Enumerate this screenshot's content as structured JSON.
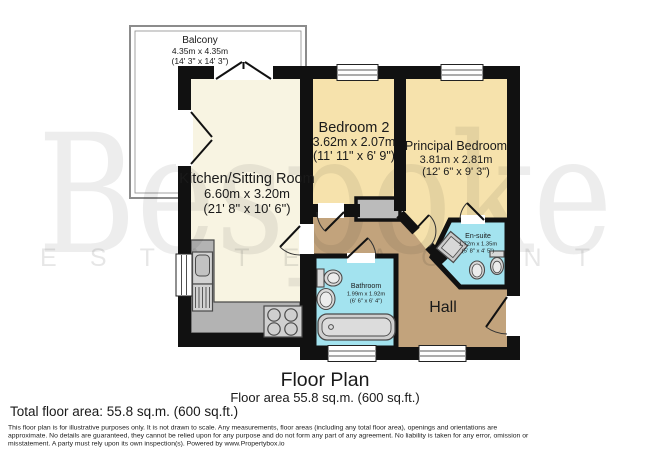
{
  "watermark": {
    "brand": "Bespoke",
    "tagline": "ESTATE AGENT"
  },
  "rooms": {
    "balcony": {
      "name": "Balcony",
      "metric": "4.35m x 4.35m",
      "imperial": "(14' 3\" x 14' 3\")"
    },
    "kitchen": {
      "name": "Kitchen/Sitting Room",
      "metric": "6.60m x 3.20m",
      "imperial": "(21' 8\" x 10' 6\")"
    },
    "bedroom2": {
      "name": "Bedroom 2",
      "metric": "3.62m x 2.07m",
      "imperial": "(11' 11\" x 6' 9\")"
    },
    "principal": {
      "name": "Principal Bedroom",
      "metric": "3.81m x 2.81m",
      "imperial": "(12' 6\" x 9' 3\")"
    },
    "ensuite": {
      "name": "En-suite",
      "metric": "1.72m x 1.35m",
      "imperial": "(5' 8\" x 4' 5\")"
    },
    "bathroom": {
      "name": "Bathroom",
      "metric": "1.99m x 1.92m",
      "imperial": "(6' 6\" x 6' 4\")"
    },
    "hall": {
      "name": "Hall"
    }
  },
  "footer": {
    "title": "Floor Plan",
    "area_line": "Floor area 55.8 sq.m. (600 sq.ft.)",
    "total_area": "Total floor area: 55.8 sq.m. (600 sq.ft.)",
    "disclaimer": [
      "This floor plan is for illustrative purposes only. It is not drawn to scale. Any measurements, floor areas (including any total floor area), openings and orientations are",
      "approximate. No details are guaranteed, they cannot be relied upon for any purpose and do not form any part of any agreement. No liability is taken for any error, omission or",
      "misstatement. A party must rely upon its own inspection(s). Powered by www.Propertybox.io"
    ]
  },
  "colors": {
    "wall": "#111111",
    "kitchen_floor": "#F8F4E2",
    "bedroom_floor": "#F6E2AC",
    "wet_room_floor": "#A3E3EF",
    "hall_floor": "#C2A37C",
    "fixture_gray": "#C9C9C9",
    "balcony_rail": "#8C8C8C"
  }
}
